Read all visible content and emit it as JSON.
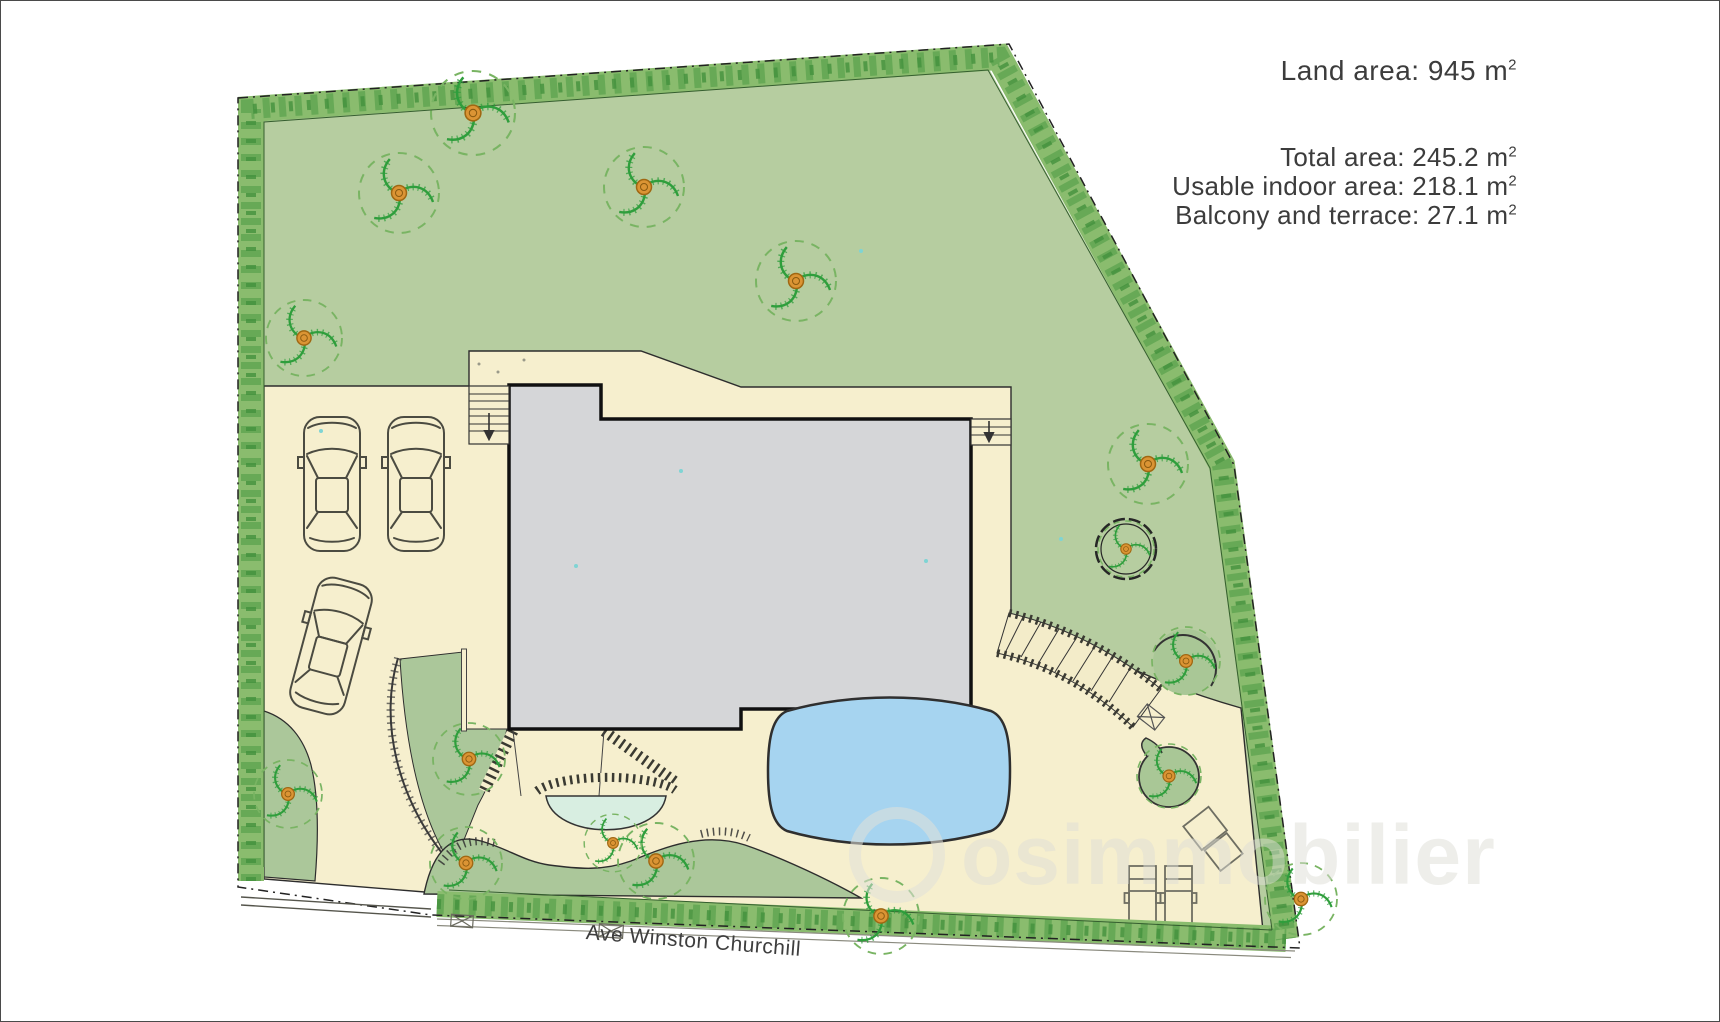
{
  "areas": {
    "land": {
      "text": "Land area: 945 m",
      "sup": "2"
    },
    "total": {
      "text": "Total area: 245.2 m",
      "sup": "2"
    },
    "indoor": {
      "text": "Usable indoor area: 218.1 m",
      "sup": "2"
    },
    "balcony": {
      "text": "Balcony and terrace: 27.1 m",
      "sup": "2"
    }
  },
  "street": {
    "name": "Ave Winston Churchill"
  },
  "watermark": {
    "text": "osimmobilier"
  },
  "colors": {
    "lawn": "#b6cda0",
    "garden_bed": "#abc79a",
    "hedge": "#8abc6e",
    "hardscape": "#f6efce",
    "building": "#d5d6d8",
    "pool": "#a6d4f0",
    "spa": "#d8eee1",
    "tree_trunk": "#db9434",
    "outline": "#2d2d2d"
  },
  "plan_features": {
    "building_footprints": 1,
    "swimming_pools": 1,
    "plunge_pools": 1,
    "parked_cars": 3,
    "sun_loungers": 3,
    "exterior_stairs": 3,
    "entrance_gates": 1,
    "boundary": "hedge on all sides with gate opening at bottom-left"
  }
}
